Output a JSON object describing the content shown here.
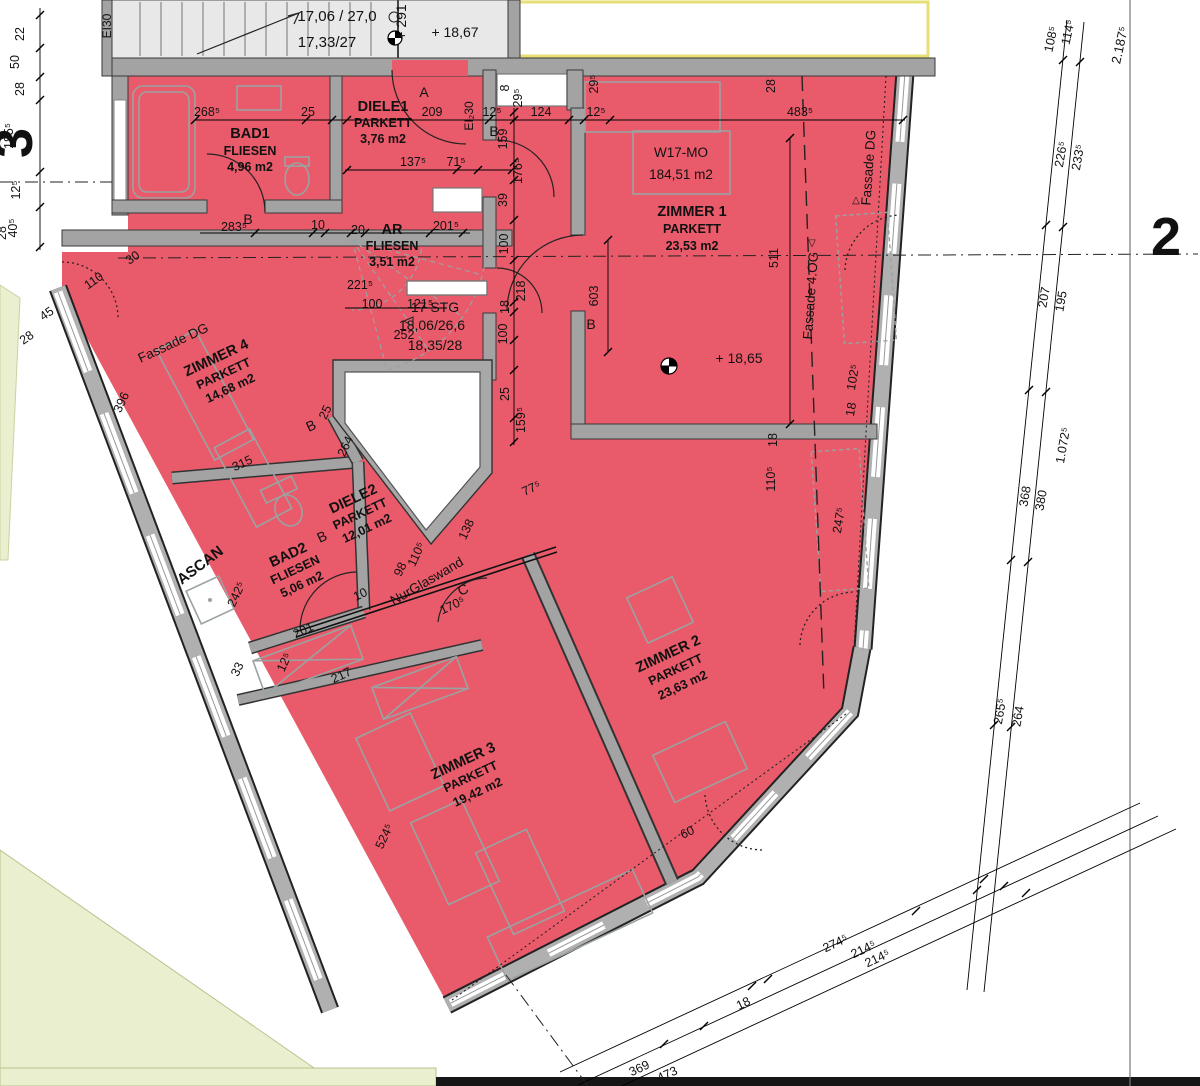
{
  "apartment": {
    "id": "W17-MO",
    "area": "184,51 m2"
  },
  "rooms": {
    "bad1": {
      "name": "BAD1",
      "material": "FLIESEN",
      "area": "4,96 m2"
    },
    "diele1": {
      "name": "DIELE1",
      "material": "PARKETT",
      "area": "3,76 m2"
    },
    "zimmer1": {
      "name": "ZIMMER 1",
      "material": "PARKETT",
      "area": "23,53 m2"
    },
    "ar": {
      "name": "AR",
      "material": "FLIESEN",
      "area": "3,51 m2"
    },
    "zimmer4": {
      "name": "ZIMMER 4",
      "material": "PARKETT",
      "area": "14,68 m2"
    },
    "diele2": {
      "name": "DIELE2",
      "material": "PARKETT",
      "area": "12,01 m2"
    },
    "bad2": {
      "name": "BAD2",
      "material": "FLIESEN",
      "area": "5,06 m2"
    },
    "zimmer2": {
      "name": "ZIMMER 2",
      "material": "PARKETT",
      "area": "23,63 m2"
    },
    "zimmer3": {
      "name": "ZIMMER 3",
      "material": "PARKETT",
      "area": "19,42 m2"
    }
  },
  "levels": {
    "upper": "+ 18,67",
    "zimmer1": "+ 18,65",
    "shaft": "+ 291"
  },
  "stair_main": {
    "run_a": "17,06 / 27,0",
    "run_b": "17,33/27"
  },
  "stair_spiral": {
    "count": "17 STG",
    "run_a": "18,06/26,6",
    "run_b": "18,35/28"
  },
  "grid": {
    "axis_right": "2",
    "axis_left": "3",
    "overall": "2.187⁵"
  },
  "annotations": {
    "fassade_dg": "Fassade DG",
    "fassade_4og": "Fassade 4.OG",
    "glass_wall": "NurGlaswand",
    "ascan": "ASCAN",
    "fire_door_top": "EI30",
    "fire_door_entry": "EI₂30",
    "letter_a": "A",
    "letter_b": "B",
    "letter_c": "C",
    "tri_down": "▽",
    "tri_up": "△"
  },
  "colors": {
    "apartment_fill": "#e95b6b",
    "wall": "#a3a3a3",
    "stair_floor": "#e8e8e8",
    "green": "#e9efcf",
    "yellow": "#e6df74"
  },
  "dims": {
    "d01": "268⁵",
    "d02": "25",
    "d03": "209",
    "d04": "12⁵",
    "d05": "124",
    "d06": "12⁵",
    "d07": "483⁵",
    "d08": "137⁵",
    "d09": "71⁵",
    "d10": "29⁵",
    "d11": "29⁵",
    "d12": "8",
    "d13": "28",
    "d14": "22",
    "d15": "50",
    "d16": "28",
    "d17": "185⁵",
    "d18": "12⁵",
    "d19": "40⁵",
    "d20": "28",
    "d21": "159",
    "d22": "176⁵",
    "d23": "39",
    "d24": "100",
    "d25": "218",
    "d26": "18",
    "d27": "100",
    "d28": "25",
    "d29": "159⁵",
    "d30": "603",
    "d31": "511",
    "d32": "283⁵",
    "d33": "10",
    "d34": "20",
    "d35": "201⁵",
    "d36": "221⁵",
    "d37": "100",
    "d38": "121⁵",
    "d39": "252",
    "d40": "30",
    "d41": "110",
    "d42": "45",
    "d43": "28",
    "d44": "396",
    "d45": "315",
    "d46": "25",
    "d47": "264",
    "d48": "242⁵",
    "d49": "201",
    "d50": "12⁵",
    "d51": "33",
    "d52": "217",
    "d53": "10",
    "d54": "98",
    "d55": "110⁵",
    "d56": "138",
    "d57": "170⁵",
    "d58": "77⁵",
    "d59": "18",
    "d60": "110⁵",
    "d61": "18",
    "d62": "102⁵",
    "d63": "247⁵",
    "d64": "60",
    "d65": "524⁵",
    "d66": "108⁵",
    "d67": "114⁵",
    "d68": "226⁵",
    "d69": "233⁵",
    "d70": "207",
    "d71": "195",
    "d72": "1.072⁵",
    "d73": "368",
    "d74": "380",
    "d75": "265⁵",
    "d76": "264",
    "d77": "274⁵",
    "d78": "214⁵",
    "d79": "214⁵",
    "d80": "18",
    "d81": "369",
    "d82": "473"
  }
}
